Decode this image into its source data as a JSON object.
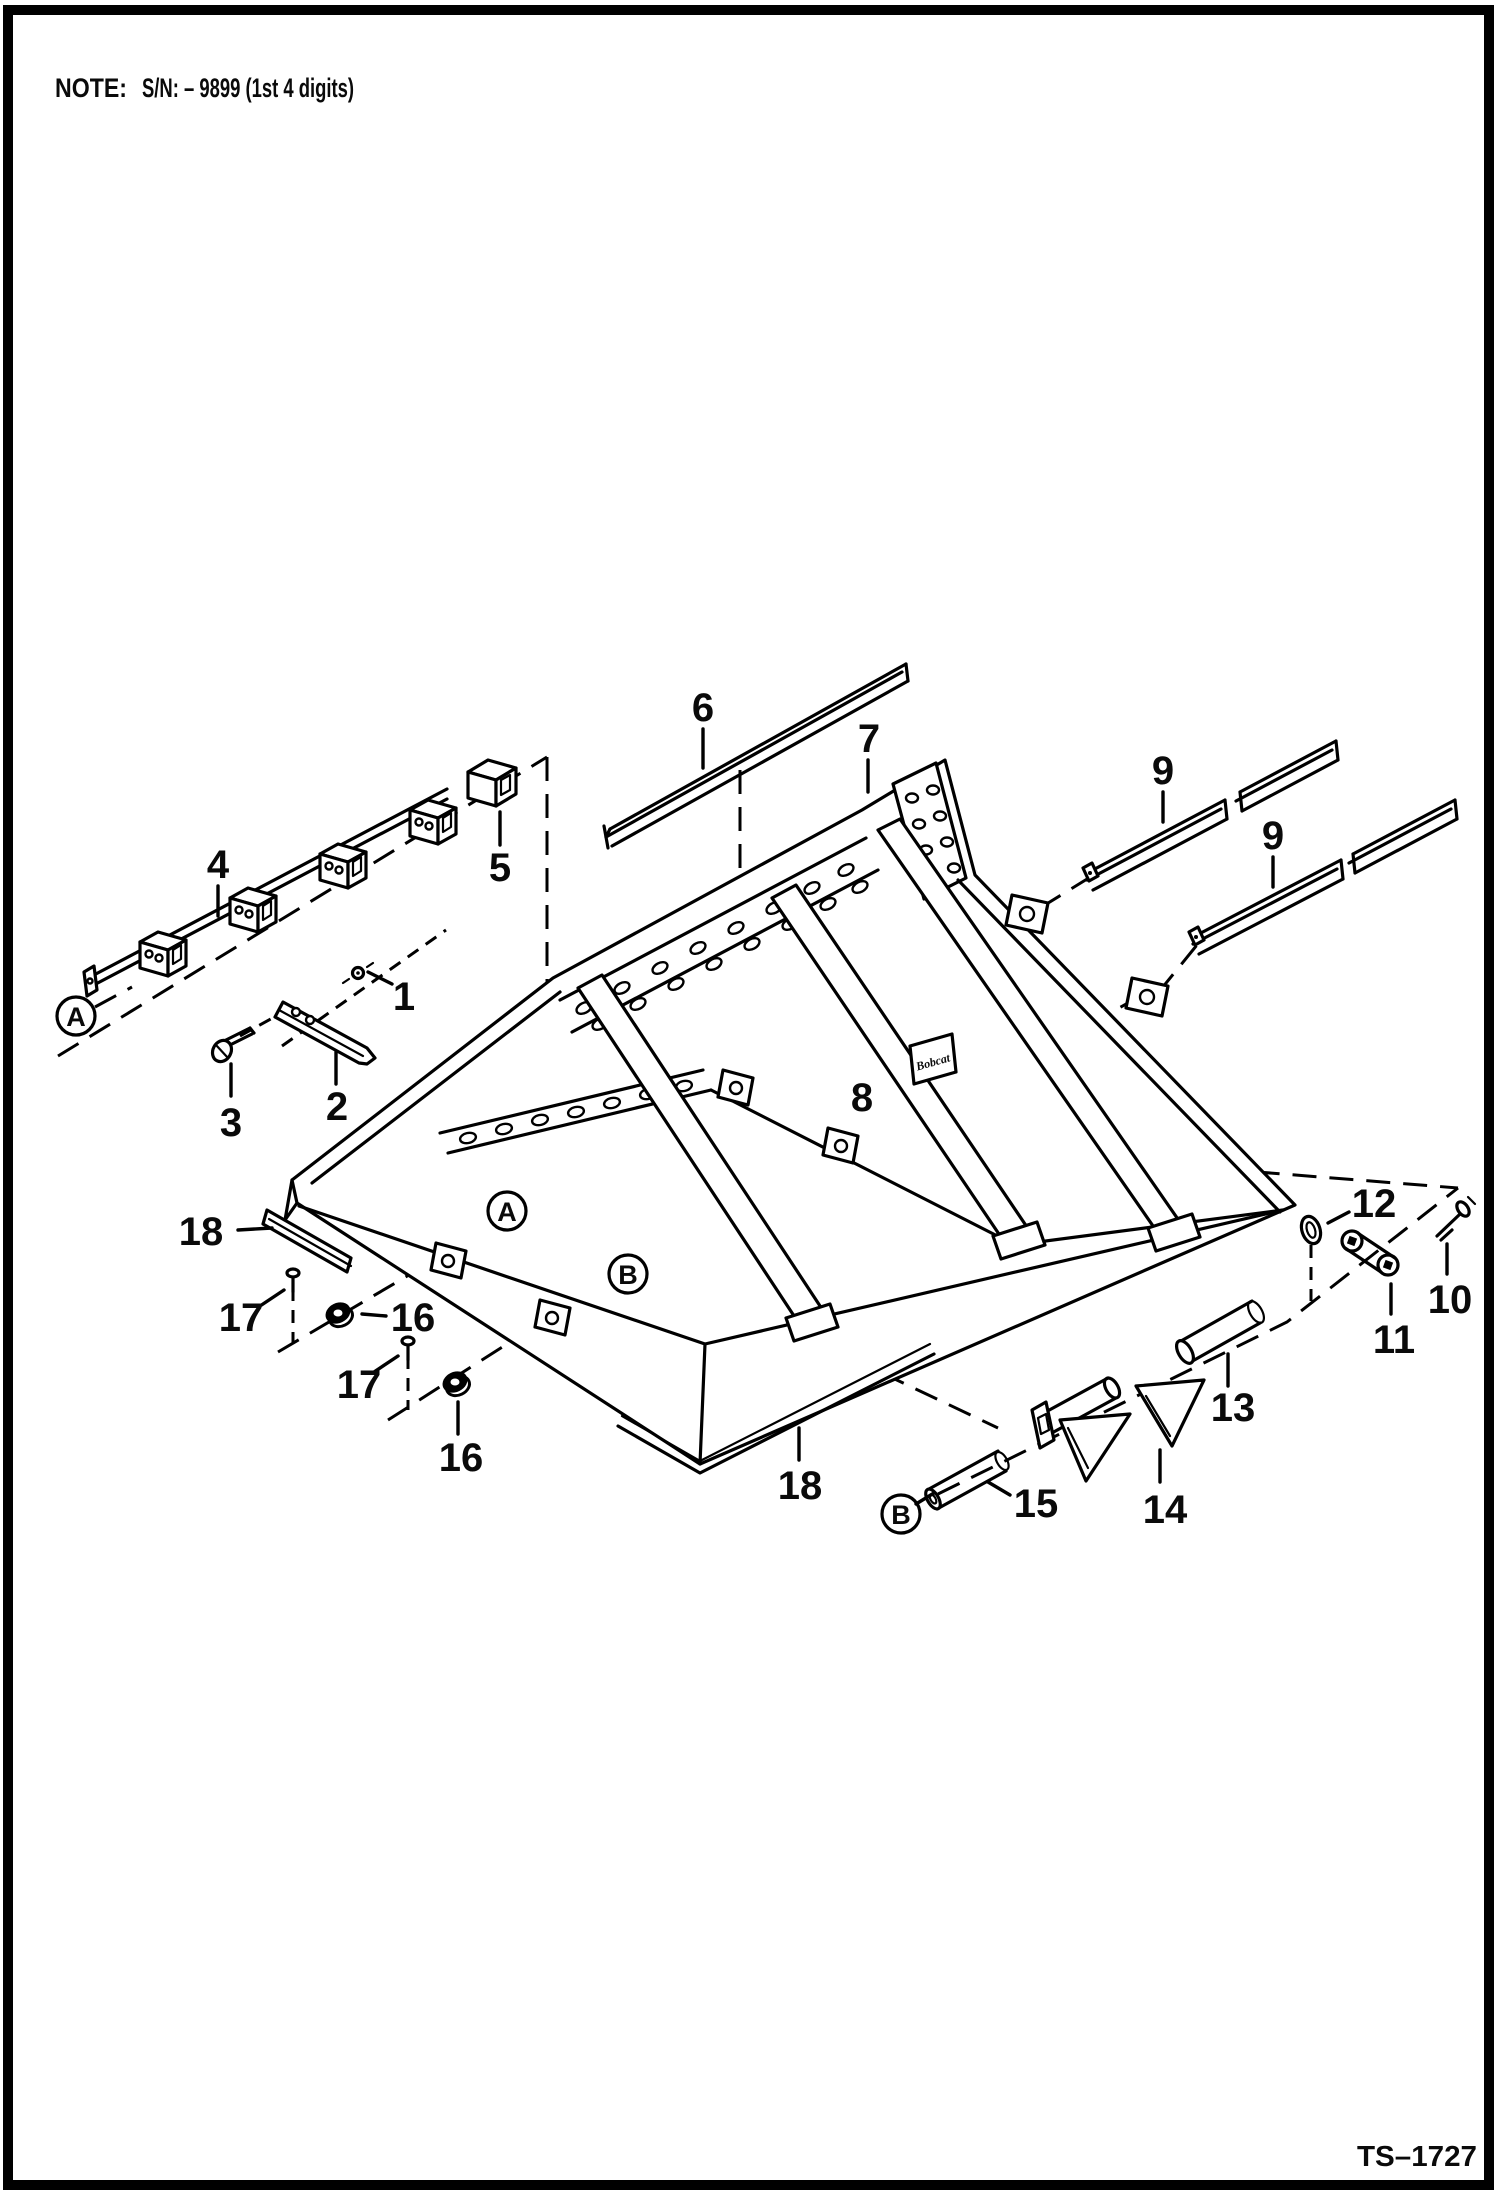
{
  "page": {
    "note_label": "NOTE:",
    "note_text": "S/N: – 9899 (1st 4 digits)",
    "drawing_code": "TS–1727"
  },
  "diagram": {
    "decal_text": "Bobcat",
    "callouts": [
      {
        "label": "1"
      },
      {
        "label": "2"
      },
      {
        "label": "3"
      },
      {
        "label": "4"
      },
      {
        "label": "5"
      },
      {
        "label": "6"
      },
      {
        "label": "7"
      },
      {
        "label": "8"
      },
      {
        "label": "9"
      },
      {
        "label": "9"
      },
      {
        "label": "10"
      },
      {
        "label": "11"
      },
      {
        "label": "12"
      },
      {
        "label": "13"
      },
      {
        "label": "14"
      },
      {
        "label": "15"
      },
      {
        "label": "16"
      },
      {
        "label": "16"
      },
      {
        "label": "17"
      },
      {
        "label": "17"
      },
      {
        "label": "18"
      },
      {
        "label": "18"
      }
    ],
    "reference_bubbles": [
      {
        "label": "A"
      },
      {
        "label": "A"
      },
      {
        "label": "B"
      },
      {
        "label": "B"
      }
    ]
  },
  "colors": {
    "ink": "#000000",
    "paper": "#ffffff"
  }
}
